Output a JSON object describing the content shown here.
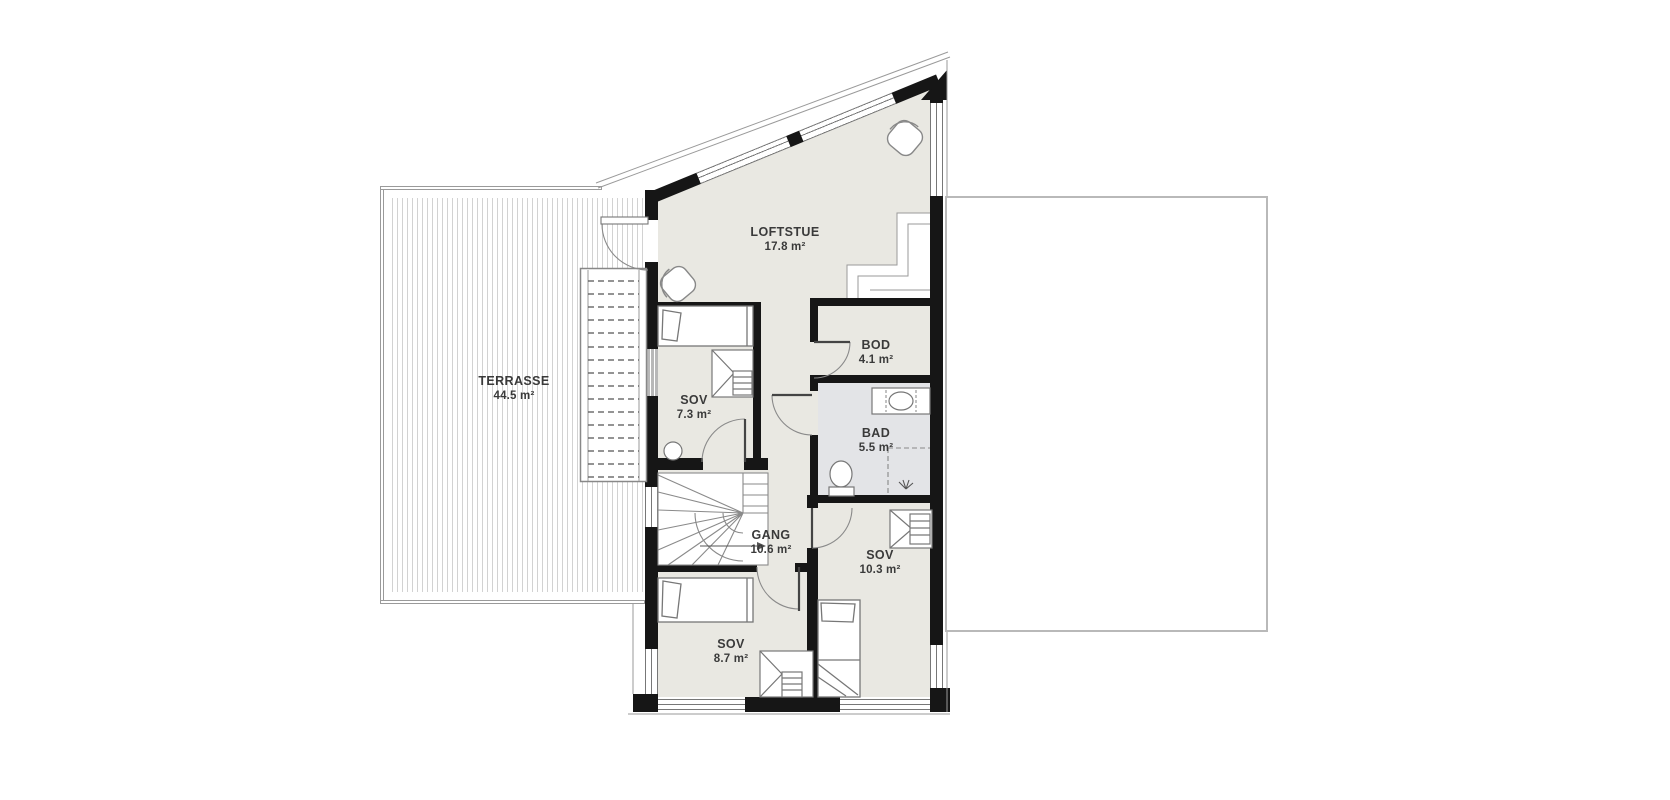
{
  "plan": {
    "rooms": [
      {
        "key": "terrasse",
        "name": "TERRASSE",
        "area": "44.5 m²"
      },
      {
        "key": "loftstue",
        "name": "LOFTSTUE",
        "area": "17.8 m²"
      },
      {
        "key": "sov-1",
        "name": "SOV",
        "area": "7.3 m²"
      },
      {
        "key": "bod",
        "name": "BOD",
        "area": "4.1 m²"
      },
      {
        "key": "bad",
        "name": "BAD",
        "area": "5.5 m²"
      },
      {
        "key": "gang",
        "name": "GANG",
        "area": "10.6 m²"
      },
      {
        "key": "sov-2",
        "name": "SOV",
        "area": "10.3 m²"
      },
      {
        "key": "sov-3",
        "name": "SOV",
        "area": "8.7 m²"
      }
    ],
    "colors": {
      "floor": "#e9e8e2",
      "bathroom_floor": "#e3e4e7",
      "wall": "#161616",
      "outline": "#8a8a8a",
      "deck_stripe": "#d2d2d2",
      "lower_roof_border": "#b9b9b9",
      "text": "#3a3a3a"
    }
  }
}
